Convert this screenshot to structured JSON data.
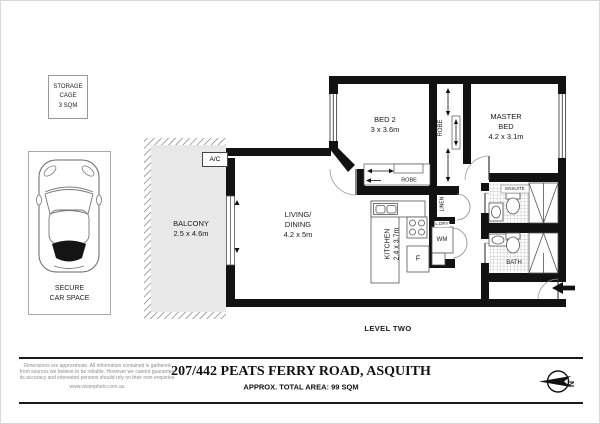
{
  "storage_cage": {
    "line1": "STORAGE",
    "line2": "CAGE",
    "line3": "3 SQM"
  },
  "car_space": {
    "line1": "SECURE",
    "line2": "CAR SPACE"
  },
  "plan": {
    "level_label": "LEVEL TWO",
    "balcony": {
      "name": "BALCONY",
      "dims": "2.5 x 4.6m"
    },
    "living": {
      "name1": "LIVING/",
      "name2": "DINING",
      "dims": "4.2 x 5m"
    },
    "bed2": {
      "name": "BED 2",
      "dims": "3 x 3.6m"
    },
    "master": {
      "name1": "MASTER",
      "name2": "BED",
      "dims": "4.2 x 3.1m"
    },
    "kitchen": {
      "name": "KITCHEN",
      "dims": "2.4 x 3.7m"
    },
    "robe_corridor": "ROBE",
    "robe_bed2": "ROBE",
    "linen": "LINEN",
    "laundry": "L.DRY",
    "washing_machine": "WM",
    "fridge": "F",
    "ensuite": "ENSUITE",
    "bath": "BATH",
    "ac": "A/C"
  },
  "footer": {
    "disclaimer1": "Dimensions are approximate. All information contained is gathered",
    "disclaimer2": "from sources we believe to be reliable. However we cannot guarantee",
    "disclaimer3": "its accuracy and interested persons should rely on their own enquiries",
    "website": "www.visionphoto.com.au",
    "title": "207/442 PEATS FERRY ROAD, ASQUITH",
    "subtitle": "APPROX. TOTAL AREA: 99 SQM",
    "compass_n": "N"
  },
  "colors": {
    "wall": "#121212",
    "balcony_fill": "#e8e8e8",
    "rule": "#1a1a1a"
  }
}
